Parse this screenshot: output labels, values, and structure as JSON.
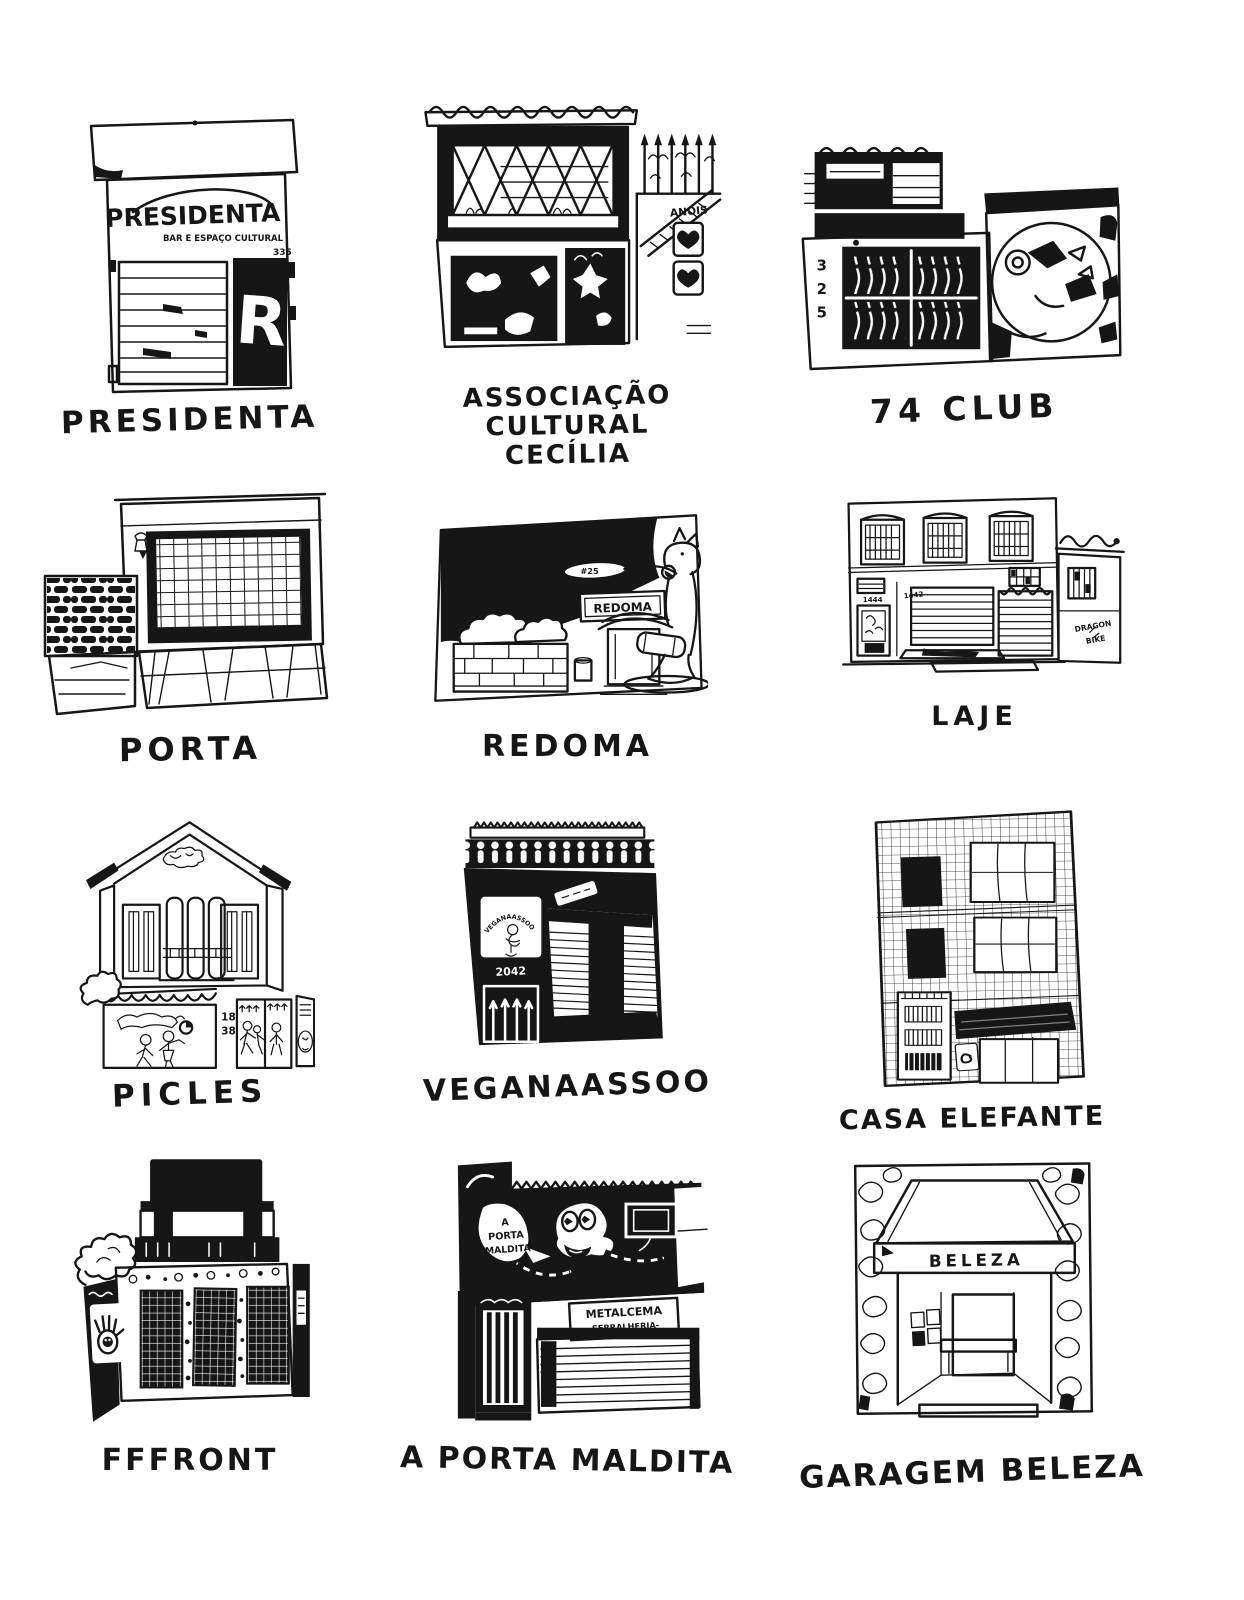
{
  "page": {
    "background": "#ffffff",
    "ink": "#161616"
  },
  "buildings": [
    {
      "id": "presidenta",
      "label": "PRESIDENTA",
      "signs": {
        "title": "PRESIDENTA",
        "subtitle": "BAR E ESPAÇO CULTURAL",
        "number": "335",
        "poster_letter": "R"
      }
    },
    {
      "id": "associacao-cultural-cecilia",
      "label": "ASSOCIAÇÃO CULTURAL\nCECÍLIA",
      "signs": {
        "graffiti": "ANOIS"
      }
    },
    {
      "id": "74club",
      "label": "74 CLUB",
      "signs": {
        "d1": "3",
        "d2": "2",
        "d3": "5"
      }
    },
    {
      "id": "porta",
      "label": "PORTA",
      "signs": {}
    },
    {
      "id": "redoma",
      "label": "REDOMA",
      "signs": {
        "plaque": "REDOMA",
        "number": "#25"
      }
    },
    {
      "id": "laje",
      "label": "LAJE",
      "signs": {
        "number_door": "1444",
        "number_wall": "1442",
        "side_line1": "DRAGON",
        "side_line2": "BIKE"
      }
    },
    {
      "id": "picles",
      "label": "PICLES",
      "signs": {
        "number_top": "18",
        "number_bottom": "38"
      }
    },
    {
      "id": "veganaassoo",
      "label": "VEGANAASSOO",
      "signs": {
        "logo_arc": "VEGANAASSOO",
        "number": "2042"
      }
    },
    {
      "id": "casa-elefante",
      "label": "CASA ELEFANTE",
      "signs": {}
    },
    {
      "id": "fffront",
      "label": "FFFRONT",
      "signs": {}
    },
    {
      "id": "a-porta-maldita",
      "label": "A PORTA MALDITA",
      "signs": {
        "bubble_l1": "A",
        "bubble_l2": "PORTA",
        "bubble_l3": "MALDITA",
        "plate_l1": "METALCEMA",
        "plate_l2": "-SERRALHERIA-"
      }
    },
    {
      "id": "garagem-beleza",
      "label": "GARAGEM BELEZA",
      "signs": {
        "awning": "BELEZA"
      }
    }
  ]
}
